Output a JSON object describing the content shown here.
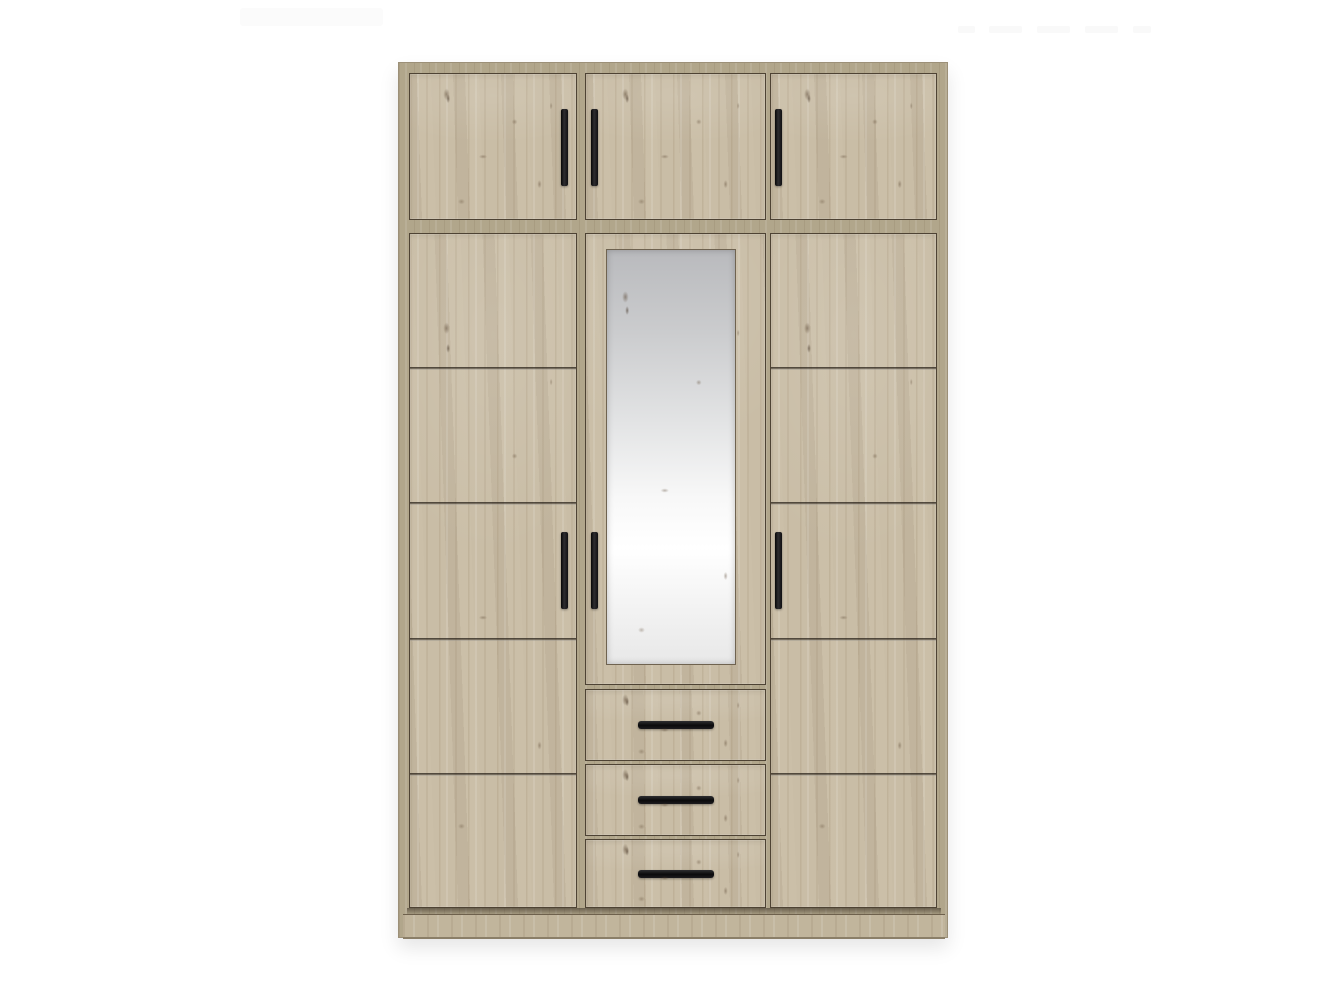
{
  "scene": {
    "type": "furniture product photo on white background",
    "background_color": "#ffffff",
    "ghost_artifacts": {
      "toolbar_color": "#fbfbfb",
      "menu_item_color": "#f9f9f9",
      "menu_item_count": 5
    }
  },
  "wardrobe": {
    "finish": "light artisan oak woodgrain",
    "colors": {
      "door_face": "#c9bda6",
      "carcass_frame": "#b1a68b",
      "edge_outline": "#4e4334",
      "groove_line": "#37302a",
      "handle_black": "#1a191b",
      "plinth": "#c1b59c",
      "mirror_gray_top": "#b9babd",
      "mirror_highlight": "#ffffff"
    },
    "layout": {
      "columns": 3,
      "top_cabinet_doors": 3,
      "tall_side_doors": 2,
      "grooves_per_side_door": 4,
      "mirror_doors": 1,
      "mirrors": 1,
      "drawers": 3,
      "vertical_handles": 6,
      "horizontal_drawer_handles": 3
    }
  }
}
